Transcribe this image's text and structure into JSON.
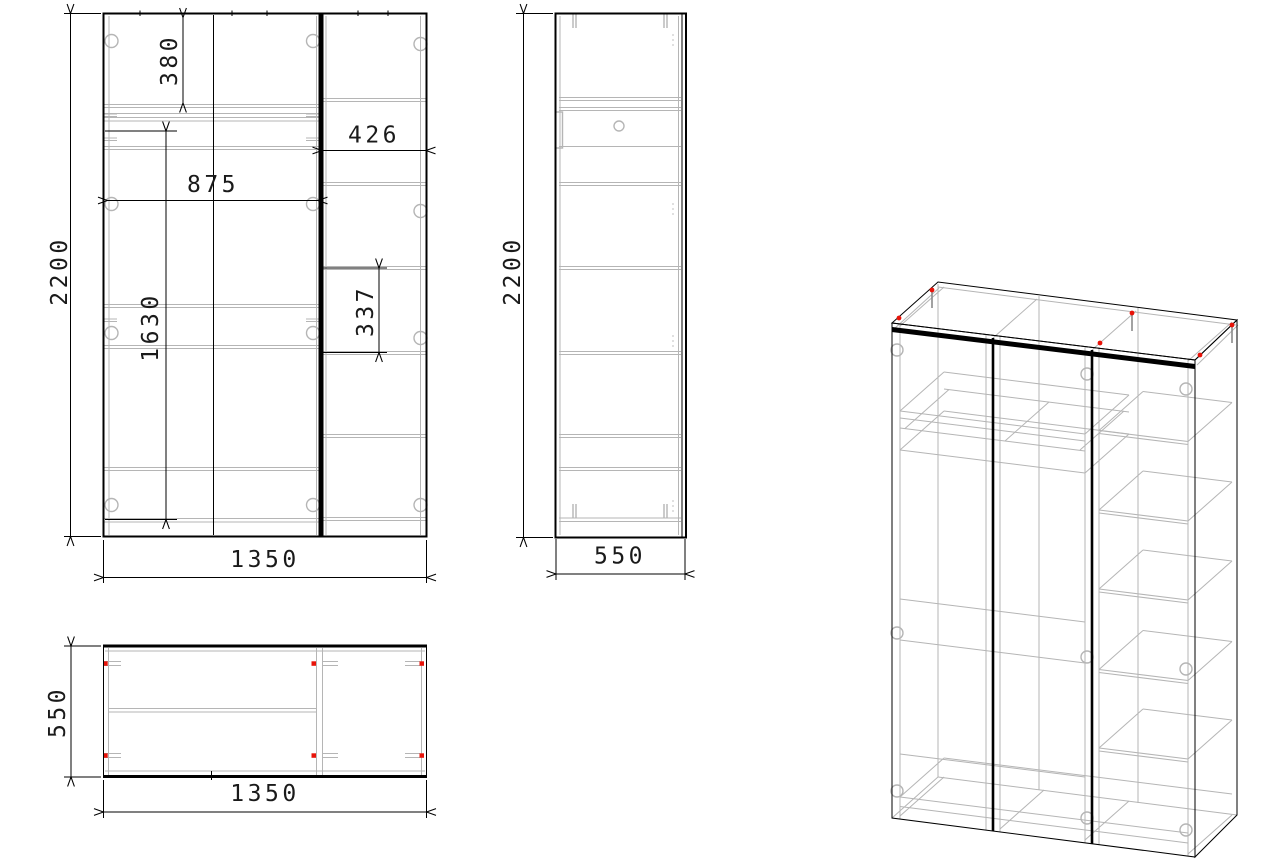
{
  "drawing": {
    "type": "furniture-technical-drawing",
    "background": "#ffffff",
    "colors": {
      "primary_line": "#000000",
      "secondary_line": "#b5b5b5",
      "connector_mark": "#e81309"
    },
    "views": {
      "front": {
        "dims": {
          "height": "2200",
          "width": "1350",
          "top_compartment": "380",
          "left_section_width": "875",
          "hanging_height": "1630",
          "right_section_width": "426",
          "shelf_spacing": "337"
        }
      },
      "side": {
        "dims": {
          "height": "2200",
          "depth": "550"
        }
      },
      "plan": {
        "dims": {
          "depth": "550",
          "width": "1350"
        }
      }
    }
  }
}
